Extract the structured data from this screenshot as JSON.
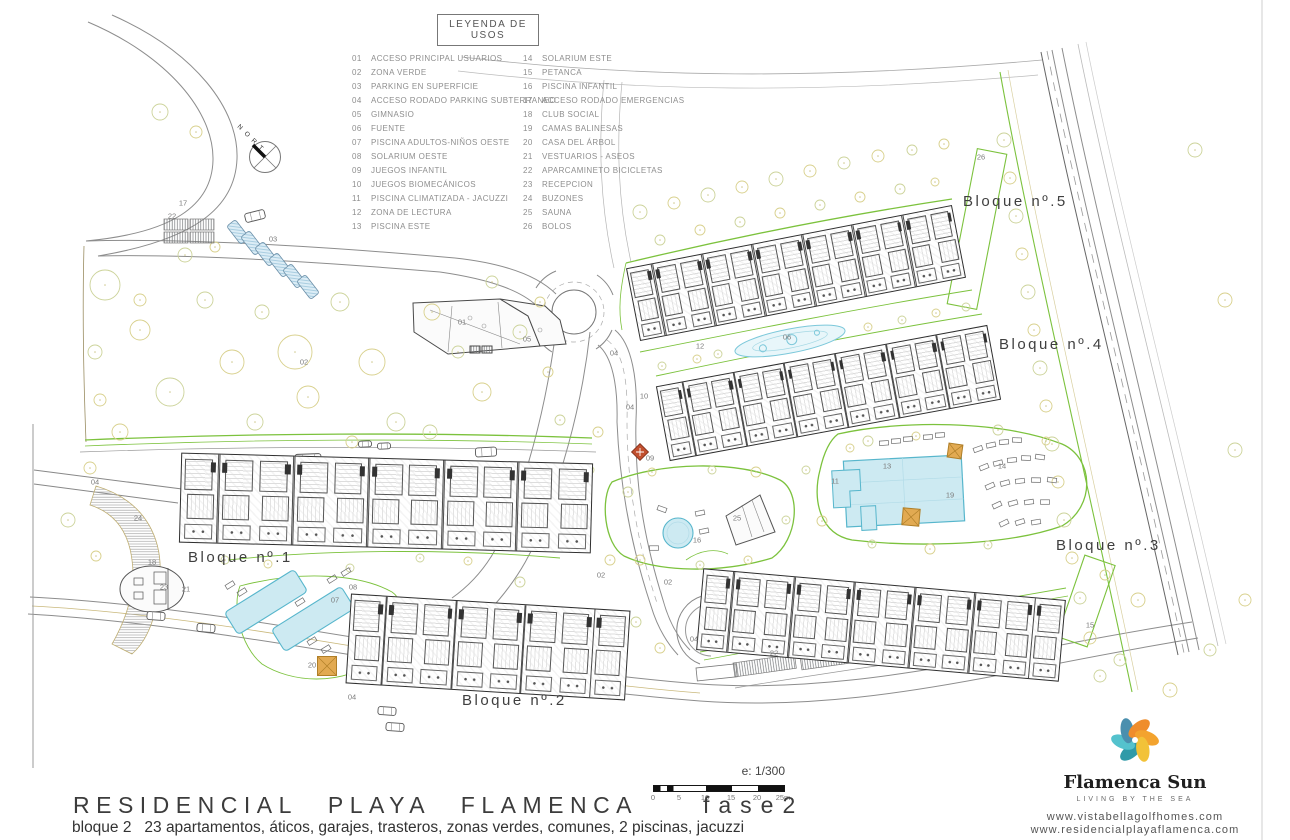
{
  "legend": {
    "title": "LEYENDA DE USOS",
    "items": [
      {
        "num": "01",
        "label": "ACCESO PRINCIPAL USUARIOS"
      },
      {
        "num": "02",
        "label": "ZONA VERDE"
      },
      {
        "num": "03",
        "label": "PARKING EN SUPERFICIE"
      },
      {
        "num": "04",
        "label": "ACCESO RODADO PARKING SUBTERRANEO"
      },
      {
        "num": "05",
        "label": "GIMNASIO"
      },
      {
        "num": "06",
        "label": "FUENTE"
      },
      {
        "num": "07",
        "label": "PISCINA ADULTOS-NIÑOS OESTE"
      },
      {
        "num": "08",
        "label": "SOLARIUM OESTE"
      },
      {
        "num": "09",
        "label": "JUEGOS INFANTIL"
      },
      {
        "num": "10",
        "label": "JUEGOS BIOMECÁNICOS"
      },
      {
        "num": "11",
        "label": "PISCINA CLIMATIZADA - JACUZZI"
      },
      {
        "num": "12",
        "label": "ZONA DE LECTURA"
      },
      {
        "num": "13",
        "label": "PISCINA ESTE"
      },
      {
        "num": "14",
        "label": "SOLARIUM ESTE"
      },
      {
        "num": "15",
        "label": "PETANCA"
      },
      {
        "num": "16",
        "label": "PISCINA INFANTIL"
      },
      {
        "num": "17",
        "label": "ACCESO RODADO EMERGENCIAS"
      },
      {
        "num": "18",
        "label": "CLUB SOCIAL"
      },
      {
        "num": "19",
        "label": "CAMAS BALINESAS"
      },
      {
        "num": "20",
        "label": "CASA DEL ÁRBOL"
      },
      {
        "num": "21",
        "label": "VESTUARIOS - ASEOS"
      },
      {
        "num": "22",
        "label": "APARCAMINETO BICICLETAS"
      },
      {
        "num": "23",
        "label": "RECEPCION"
      },
      {
        "num": "24",
        "label": "BUZONES"
      },
      {
        "num": "25",
        "label": "SAUNA"
      },
      {
        "num": "26",
        "label": "BOLOS"
      }
    ]
  },
  "blocks": [
    {
      "label": "Bloque nº.1"
    },
    {
      "label": "Bloque nº.2"
    },
    {
      "label": "Bloque nº.3"
    },
    {
      "label": "Bloque nº.4"
    },
    {
      "label": "Bloque nº.5"
    }
  ],
  "plan_markers": [
    {
      "label": "17",
      "x": 183,
      "y": 203
    },
    {
      "label": "22",
      "x": 172,
      "y": 216
    },
    {
      "label": "03",
      "x": 273,
      "y": 239
    },
    {
      "label": "01",
      "x": 462,
      "y": 322
    },
    {
      "label": "05",
      "x": 527,
      "y": 339
    },
    {
      "label": "04",
      "x": 614,
      "y": 353
    },
    {
      "label": "04",
      "x": 630,
      "y": 407
    },
    {
      "label": "10",
      "x": 644,
      "y": 396
    },
    {
      "label": "12",
      "x": 700,
      "y": 346
    },
    {
      "label": "06",
      "x": 787,
      "y": 337
    },
    {
      "label": "02",
      "x": 304,
      "y": 362
    },
    {
      "label": "02",
      "x": 601,
      "y": 575
    },
    {
      "label": "02",
      "x": 668,
      "y": 582
    },
    {
      "label": "09",
      "x": 650,
      "y": 458
    },
    {
      "label": "16",
      "x": 697,
      "y": 540
    },
    {
      "label": "25",
      "x": 737,
      "y": 518
    },
    {
      "label": "11",
      "x": 835,
      "y": 481
    },
    {
      "label": "13",
      "x": 887,
      "y": 466
    },
    {
      "label": "14",
      "x": 1002,
      "y": 466
    },
    {
      "label": "19",
      "x": 950,
      "y": 495
    },
    {
      "label": "15",
      "x": 1090,
      "y": 625
    },
    {
      "label": "18",
      "x": 152,
      "y": 562
    },
    {
      "label": "23",
      "x": 164,
      "y": 587
    },
    {
      "label": "21",
      "x": 186,
      "y": 589
    },
    {
      "label": "24",
      "x": 138,
      "y": 518
    },
    {
      "label": "26",
      "x": 981,
      "y": 157
    },
    {
      "label": "07",
      "x": 335,
      "y": 600
    },
    {
      "label": "08",
      "x": 353,
      "y": 587
    },
    {
      "label": "20",
      "x": 312,
      "y": 665
    },
    {
      "label": "04",
      "x": 95,
      "y": 482
    },
    {
      "label": "04",
      "x": 352,
      "y": 697
    },
    {
      "label": "04",
      "x": 694,
      "y": 639
    },
    {
      "label": "22",
      "x": 774,
      "y": 653
    }
  ],
  "compass": {
    "letters": [
      "N",
      "O",
      "R",
      "T"
    ]
  },
  "scalebar": {
    "scale": "e: 1/300",
    "ticks": [
      "0",
      "5",
      "10",
      "15",
      "20",
      "25m"
    ]
  },
  "footer": {
    "main_title": "RESIDENCIAL PLAYA FLAMENCA",
    "phase": "fase2",
    "subtitle": "bloque 2   23 apartamentos, áticos, garajes, trasteros, zonas verdes, comunes, 2 piscinas, jacuzzi"
  },
  "logo": {
    "name": "Flamenca Sun",
    "tagline": "LIVING BY THE SEA",
    "website1": "www.vistabellagolfhomes.com",
    "website2": "www.residencialplayaflamenca.com"
  },
  "colors": {
    "green": "#7cc23d",
    "tree": "#d8d08c",
    "tree2": "#ccd39a",
    "tan": "#c9b87b",
    "pool_fill": "#cdeaf2",
    "pool_stroke": "#57b6cc",
    "pergola": "#e2aa52",
    "pergola_edge": "#b07f28",
    "red_icon": "#c14f2e",
    "logo_yellow": "#f2c238",
    "logo_orange": "#ef8d2c",
    "logo_amber": "#f3a32e",
    "logo_teal": "#2f9aa8",
    "logo_lightteal": "#54c2cd",
    "logo_blue": "#4a8fae"
  }
}
